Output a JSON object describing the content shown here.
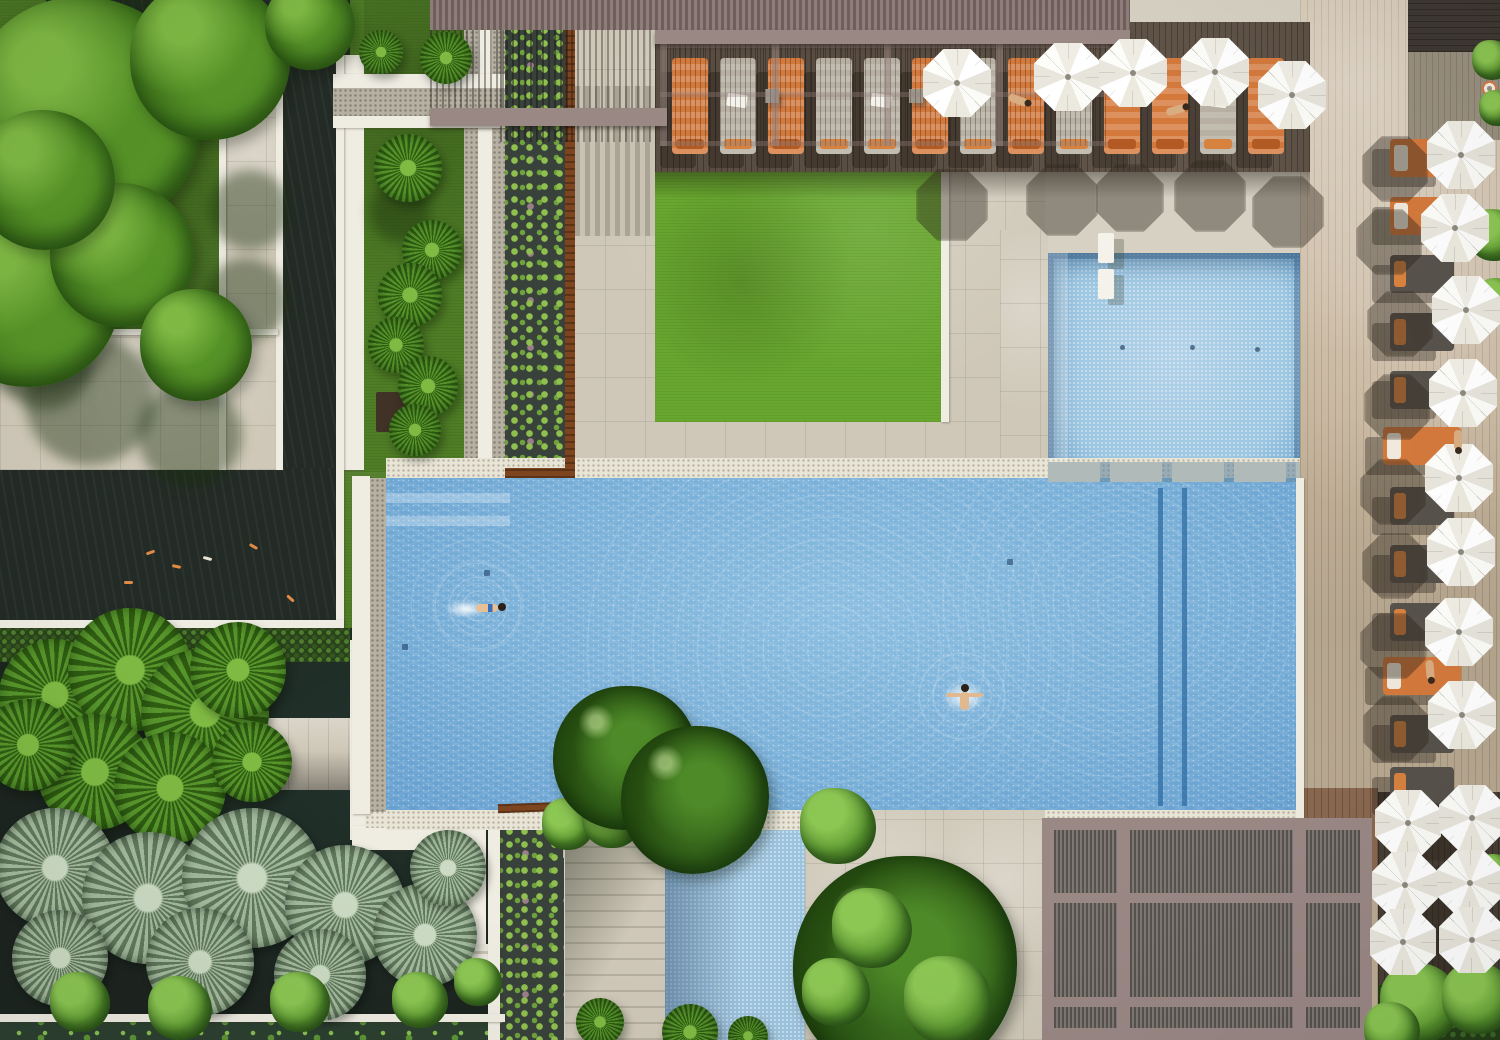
{
  "meta": {
    "type": "aerial-photograph",
    "subject": "Aerial top-down view of a resort pool courtyard with main swimming pool, kids pool, water channel, lawn, koi ponds, lily ponds, tropical gardens, timber decks, pergolas, orange sun loungers and white umbrellas",
    "canvas": {
      "w": 1500,
      "h": 1040
    },
    "visible_text": "none"
  },
  "palette": {
    "stone": "#cfc8b8",
    "white_edge": "#efece2",
    "pebble": "#e8e4d6",
    "pond_dark": "#232b26",
    "water_main": "#78afd8",
    "water_light": "#b3d2e8",
    "water_shallow": "#9cc6e1",
    "lane": "#2f6ca3",
    "lawn": "#68a72f",
    "lawn_dark": "#4f7d26",
    "corten": "#7c441f",
    "pergola_mauve": "#9a8885",
    "orange": "#d4793c",
    "skin": "#d9ad82"
  },
  "counts": {
    "umbrellas": 19,
    "loungers_top_row": 13,
    "loungers_right_column": 12,
    "swimmers": 2,
    "kids_pool_drain_dots": 3
  },
  "objects": [
    {
      "t": "shade",
      "x": 90,
      "y": 400,
      "r": 65
    },
    {
      "t": "shade",
      "x": 190,
      "y": 435,
      "r": 52
    },
    {
      "t": "shade",
      "x": 246,
      "y": 300,
      "r": 42
    },
    {
      "t": "shade",
      "x": 45,
      "y": 362,
      "r": 48
    },
    {
      "t": "shade",
      "x": 150,
      "y": 18,
      "r": 60
    },
    {
      "t": "shade",
      "x": 250,
      "y": 210,
      "r": 40
    },
    {
      "t": "shade",
      "x": 400,
      "y": 212,
      "r": 30
    },
    {
      "t": "tree",
      "x": 85,
      "y": 115,
      "r": 118
    },
    {
      "t": "tree",
      "x": 210,
      "y": 60,
      "r": 80
    },
    {
      "t": "tree",
      "x": 28,
      "y": 295,
      "r": 92
    },
    {
      "t": "tree",
      "x": 122,
      "y": 255,
      "r": 72
    },
    {
      "t": "tree",
      "x": 196,
      "y": 345,
      "r": 56
    },
    {
      "t": "tree",
      "x": 45,
      "y": 180,
      "r": 70
    },
    {
      "t": "tree",
      "x": 310,
      "y": 25,
      "r": 45
    },
    {
      "t": "palm",
      "x": 408,
      "y": 168,
      "r": 34
    },
    {
      "t": "palm",
      "x": 432,
      "y": 250,
      "r": 30
    },
    {
      "t": "palm",
      "x": 410,
      "y": 295,
      "r": 32
    },
    {
      "t": "palm",
      "x": 396,
      "y": 345,
      "r": 28
    },
    {
      "t": "palm",
      "x": 428,
      "y": 386,
      "r": 30
    },
    {
      "t": "palm",
      "x": 446,
      "y": 58,
      "r": 26
    },
    {
      "t": "palm",
      "x": 381,
      "y": 52,
      "r": 22
    },
    {
      "t": "box",
      "x": 398,
      "y": 412,
      "w": 44,
      "h": 40,
      "c": "#403227"
    },
    {
      "t": "palm",
      "x": 415,
      "y": 430,
      "r": 26
    },
    {
      "t": "koi",
      "x": 150,
      "y": 552,
      "rot": -20
    },
    {
      "t": "koi",
      "x": 176,
      "y": 566,
      "rot": 12
    },
    {
      "t": "koi",
      "x": 253,
      "y": 546,
      "rot": 30
    },
    {
      "t": "koi",
      "x": 128,
      "y": 582,
      "rot": 0
    },
    {
      "t": "koi",
      "x": 207,
      "y": 558,
      "rot": 15,
      "c": "#e9e4d6"
    },
    {
      "t": "koi",
      "x": 290,
      "y": 598,
      "rot": 42
    },
    {
      "t": "palm",
      "x": 55,
      "y": 695,
      "r": 56
    },
    {
      "t": "palm",
      "x": 130,
      "y": 670,
      "r": 62
    },
    {
      "t": "palm",
      "x": 205,
      "y": 712,
      "r": 64
    },
    {
      "t": "palm",
      "x": 95,
      "y": 772,
      "r": 58
    },
    {
      "t": "palm",
      "x": 28,
      "y": 745,
      "r": 46
    },
    {
      "t": "palm",
      "x": 170,
      "y": 788,
      "r": 56
    },
    {
      "t": "palm",
      "x": 238,
      "y": 670,
      "r": 48
    },
    {
      "t": "palm",
      "x": 252,
      "y": 762,
      "r": 40
    },
    {
      "t": "palm-gray",
      "x": 55,
      "y": 868,
      "r": 60
    },
    {
      "t": "palm-gray",
      "x": 148,
      "y": 898,
      "r": 66
    },
    {
      "t": "palm-gray",
      "x": 252,
      "y": 878,
      "r": 70
    },
    {
      "t": "palm-gray",
      "x": 345,
      "y": 905,
      "r": 60
    },
    {
      "t": "palm-gray",
      "x": 60,
      "y": 958,
      "r": 48
    },
    {
      "t": "palm-gray",
      "x": 200,
      "y": 962,
      "r": 54
    },
    {
      "t": "palm-gray",
      "x": 320,
      "y": 975,
      "r": 46
    },
    {
      "t": "palm-gray",
      "x": 425,
      "y": 935,
      "r": 52
    },
    {
      "t": "palm-gray",
      "x": 448,
      "y": 868,
      "r": 38
    },
    {
      "t": "shrub",
      "x": 80,
      "y": 1002,
      "r": 30
    },
    {
      "t": "shrub",
      "x": 180,
      "y": 1008,
      "r": 32
    },
    {
      "t": "shrub",
      "x": 300,
      "y": 1002,
      "r": 30
    },
    {
      "t": "shrub",
      "x": 420,
      "y": 1000,
      "r": 28
    },
    {
      "t": "shrub",
      "x": 478,
      "y": 982,
      "r": 24
    },
    {
      "t": "shrub",
      "x": 568,
      "y": 824,
      "r": 26
    },
    {
      "t": "shrub",
      "x": 612,
      "y": 818,
      "r": 30
    },
    {
      "t": "shrub",
      "x": 660,
      "y": 820,
      "r": 28
    },
    {
      "t": "shrub",
      "x": 706,
      "y": 824,
      "r": 26
    },
    {
      "t": "shrub",
      "x": 742,
      "y": 826,
      "r": 20
    },
    {
      "t": "shrub",
      "x": 838,
      "y": 826,
      "r": 38
    },
    {
      "t": "tree-dark",
      "x": 625,
      "y": 758,
      "r": 72
    },
    {
      "t": "tree-dark",
      "x": 695,
      "y": 800,
      "r": 74
    },
    {
      "t": "tree-dark",
      "x": 905,
      "y": 968,
      "r": 112
    },
    {
      "t": "shrub",
      "x": 872,
      "y": 928,
      "r": 40
    },
    {
      "t": "shrub",
      "x": 948,
      "y": 1000,
      "r": 44
    },
    {
      "t": "shrub",
      "x": 836,
      "y": 992,
      "r": 34
    },
    {
      "t": "palm",
      "x": 600,
      "y": 1022,
      "r": 24
    },
    {
      "t": "palm",
      "x": 690,
      "y": 1032,
      "r": 28
    },
    {
      "t": "palm",
      "x": 748,
      "y": 1036,
      "r": 20
    },
    {
      "t": "shrub",
      "x": 1420,
      "y": 1003,
      "r": 40
    },
    {
      "t": "shrub",
      "x": 1478,
      "y": 998,
      "r": 36
    },
    {
      "t": "shrub",
      "x": 1392,
      "y": 1030,
      "r": 28
    },
    {
      "t": "shrub",
      "x": 1494,
      "y": 235,
      "r": 26
    },
    {
      "t": "shrub",
      "x": 1497,
      "y": 300,
      "r": 22
    },
    {
      "t": "shrub",
      "x": 1495,
      "y": 872,
      "r": 18
    },
    {
      "t": "shrub",
      "x": 1492,
      "y": 60,
      "r": 20
    },
    {
      "t": "shrub",
      "x": 1497,
      "y": 108,
      "r": 18
    },
    {
      "t": "octshadow",
      "x": 952,
      "y": 205,
      "r": 36
    },
    {
      "t": "octshadow",
      "x": 1062,
      "y": 200,
      "r": 36
    },
    {
      "t": "octshadow",
      "x": 1130,
      "y": 198,
      "r": 34
    },
    {
      "t": "octshadow",
      "x": 1210,
      "y": 196,
      "r": 36
    },
    {
      "t": "octshadow",
      "x": 1288,
      "y": 212,
      "r": 36
    },
    {
      "t": "octshadow",
      "x": 1395,
      "y": 169,
      "r": 33
    },
    {
      "t": "octshadow",
      "x": 1389,
      "y": 242,
      "r": 33
    },
    {
      "t": "octshadow",
      "x": 1400,
      "y": 324,
      "r": 33
    },
    {
      "t": "octshadow",
      "x": 1397,
      "y": 407,
      "r": 33
    },
    {
      "t": "octshadow",
      "x": 1393,
      "y": 492,
      "r": 33
    },
    {
      "t": "octshadow",
      "x": 1395,
      "y": 566,
      "r": 33
    },
    {
      "t": "octshadow",
      "x": 1393,
      "y": 646,
      "r": 33
    },
    {
      "t": "octshadow",
      "x": 1396,
      "y": 729,
      "r": 33
    },
    {
      "t": "octshadow",
      "x": 1438,
      "y": 832,
      "r": 29
    },
    {
      "t": "octshadow",
      "x": 1436,
      "y": 894,
      "r": 28
    },
    {
      "t": "octshadow",
      "x": 1437,
      "y": 950,
      "r": 28
    },
    {
      "t": "umb",
      "x": 957,
      "y": 83,
      "r": 34
    },
    {
      "t": "umb",
      "x": 1068,
      "y": 77,
      "r": 34
    },
    {
      "t": "umb",
      "x": 1133,
      "y": 73,
      "r": 34
    },
    {
      "t": "umb",
      "x": 1215,
      "y": 72,
      "r": 34
    },
    {
      "t": "umb",
      "x": 1292,
      "y": 95,
      "r": 34
    },
    {
      "t": "umb",
      "x": 1461,
      "y": 155,
      "r": 34
    },
    {
      "t": "umb",
      "x": 1455,
      "y": 228,
      "r": 34
    },
    {
      "t": "umb",
      "x": 1466,
      "y": 310,
      "r": 34
    },
    {
      "t": "umb",
      "x": 1463,
      "y": 393,
      "r": 34
    },
    {
      "t": "umb",
      "x": 1459,
      "y": 478,
      "r": 34
    },
    {
      "t": "umb",
      "x": 1461,
      "y": 552,
      "r": 34
    },
    {
      "t": "umb",
      "x": 1459,
      "y": 632,
      "r": 34
    },
    {
      "t": "umb",
      "x": 1462,
      "y": 715,
      "r": 34
    },
    {
      "t": "umb",
      "x": 1408,
      "y": 823,
      "r": 33
    },
    {
      "t": "umb",
      "x": 1472,
      "y": 818,
      "r": 33
    },
    {
      "t": "umb",
      "x": 1405,
      "y": 885,
      "r": 33
    },
    {
      "t": "umb",
      "x": 1470,
      "y": 883,
      "r": 33
    },
    {
      "t": "umb",
      "x": 1403,
      "y": 942,
      "r": 33
    },
    {
      "t": "umb",
      "x": 1472,
      "y": 940,
      "r": 33
    },
    {
      "t": "ltop",
      "x": 690,
      "y": 106,
      "v": "orange"
    },
    {
      "t": "ltop",
      "x": 738,
      "y": 106,
      "tw": 1
    },
    {
      "t": "ltop",
      "x": 786,
      "y": 106,
      "v": "orange"
    },
    {
      "t": "ltop",
      "x": 834,
      "y": 106
    },
    {
      "t": "ltop",
      "x": 882,
      "y": 106,
      "tw": 1
    },
    {
      "t": "ltop",
      "x": 930,
      "y": 106,
      "v": "orange"
    },
    {
      "t": "ltop",
      "x": 978,
      "y": 106
    },
    {
      "t": "ltop",
      "x": 1026,
      "y": 106,
      "v": "orange"
    },
    {
      "t": "ltop",
      "x": 1074,
      "y": 106
    },
    {
      "t": "ltop",
      "x": 1122,
      "y": 106,
      "v": "orange"
    },
    {
      "t": "ltop",
      "x": 1170,
      "y": 106,
      "v": "orange"
    },
    {
      "t": "ltop",
      "x": 1218,
      "y": 106,
      "tw": 1
    },
    {
      "t": "ltop",
      "x": 1266,
      "y": 106,
      "v": "orange"
    },
    {
      "t": "table",
      "x": 772,
      "y": 96
    },
    {
      "t": "table",
      "x": 916,
      "y": 96
    },
    {
      "t": "table",
      "x": 1062,
      "y": 96
    },
    {
      "t": "lright",
      "x": 1422,
      "y": 158,
      "v": "orange"
    },
    {
      "t": "lright",
      "x": 1422,
      "y": 216,
      "v": "orange"
    },
    {
      "t": "lright",
      "x": 1422,
      "y": 274
    },
    {
      "t": "lright",
      "x": 1422,
      "y": 332
    },
    {
      "t": "lright",
      "x": 1422,
      "y": 390
    },
    {
      "t": "lright",
      "x": 1422,
      "y": 446,
      "v": "orange",
      "w": 78
    },
    {
      "t": "lright",
      "x": 1422,
      "y": 506
    },
    {
      "t": "lright",
      "x": 1422,
      "y": 564
    },
    {
      "t": "lright",
      "x": 1422,
      "y": 622
    },
    {
      "t": "lright",
      "x": 1422,
      "y": 676,
      "v": "orange",
      "w": 78
    },
    {
      "t": "lright",
      "x": 1422,
      "y": 734
    },
    {
      "t": "lright",
      "x": 1422,
      "y": 786
    },
    {
      "t": "person",
      "x": 1018,
      "y": 100,
      "rot": 20
    },
    {
      "t": "person",
      "x": 1176,
      "y": 110,
      "rot": -15
    },
    {
      "t": "person",
      "x": 1458,
      "y": 440,
      "rot": 90
    },
    {
      "t": "person",
      "x": 1430,
      "y": 670,
      "rot": 85
    },
    {
      "t": "buoy",
      "x": 1489,
      "y": 88
    },
    {
      "t": "bench",
      "x": 1106,
      "y": 248
    },
    {
      "t": "bench",
      "x": 1106,
      "y": 284
    },
    {
      "t": "swimmer",
      "x": 478,
      "y": 606,
      "v": "e"
    },
    {
      "t": "swimmer",
      "x": 962,
      "y": 696,
      "v": "t"
    },
    {
      "t": "drain",
      "x": 405,
      "y": 647
    },
    {
      "t": "drain",
      "x": 487,
      "y": 573
    },
    {
      "t": "drain",
      "x": 1010,
      "y": 562
    },
    {
      "t": "dot",
      "x": 1122,
      "y": 347
    },
    {
      "t": "dot",
      "x": 1192,
      "y": 347
    },
    {
      "t": "dot",
      "x": 1257,
      "y": 349
    }
  ]
}
